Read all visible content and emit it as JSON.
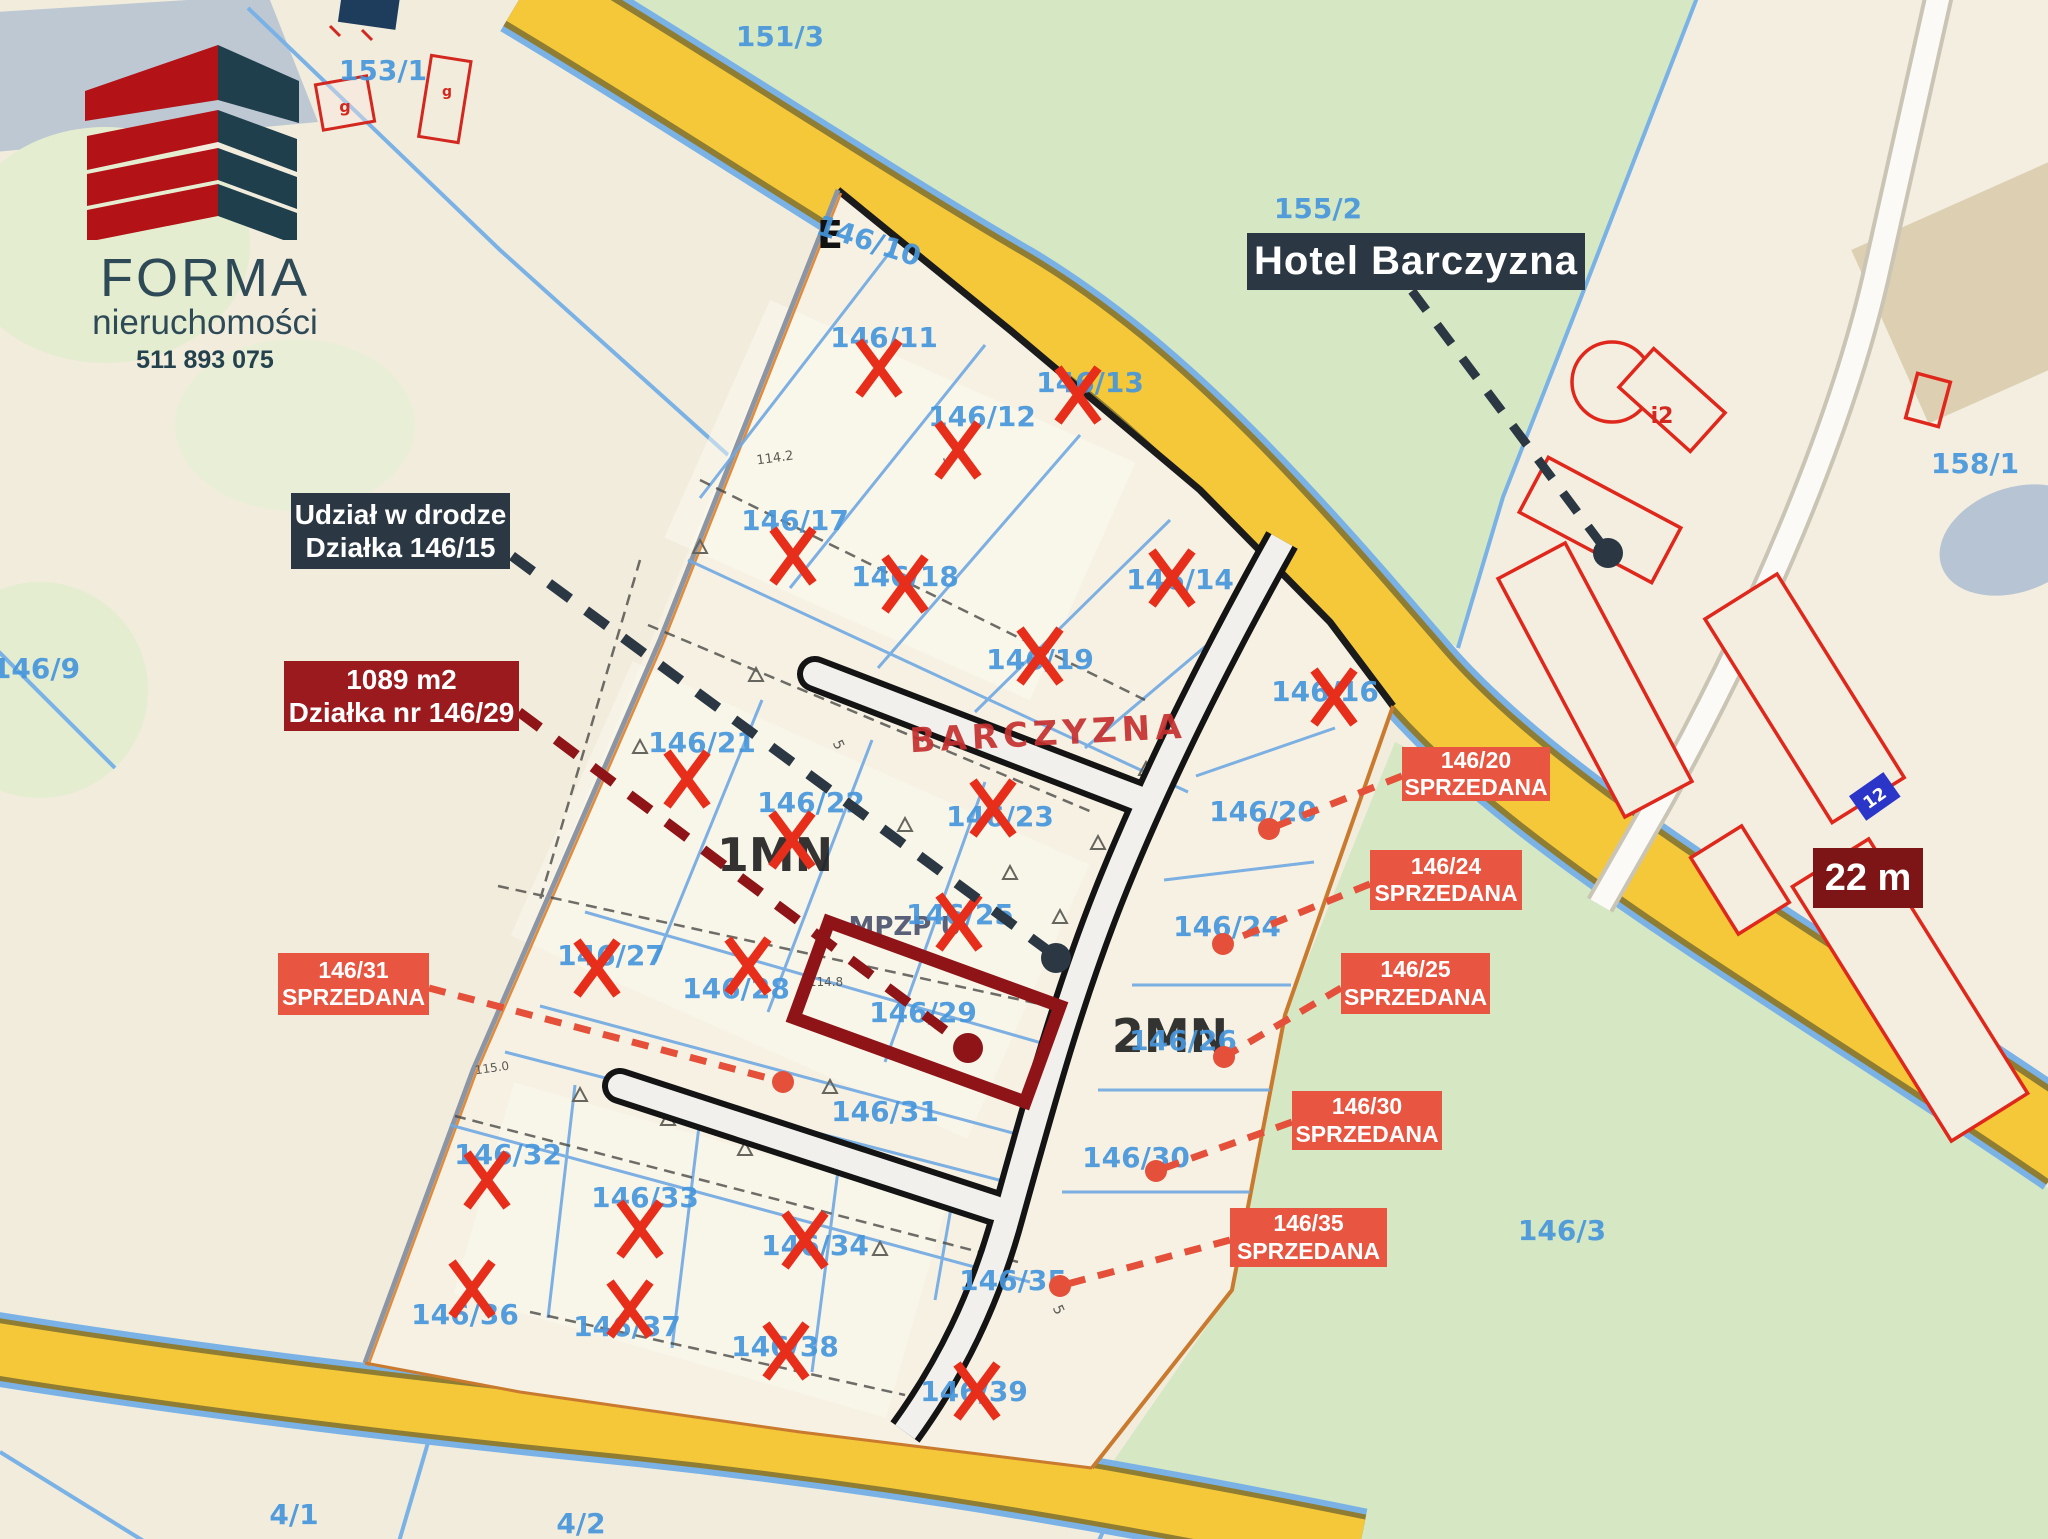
{
  "branding": {
    "company": "FORMA",
    "subtitle": "nieruchomości",
    "phone": "511 893 075"
  },
  "callouts": {
    "hotel": {
      "text": "Hotel Barczyzna",
      "bg": "#2b3844"
    },
    "road_share": {
      "line1": "Udział w drodze",
      "line2": "Działka 146/15",
      "bg": "#2b3844"
    },
    "offer": {
      "line1": "1089 m2",
      "line2": "Działka nr 146/29",
      "bg": "#9a1a1d"
    },
    "frontage": {
      "text": "22 m",
      "bg": "#7d1517"
    },
    "sold_status": "SPRZEDANA",
    "sold_color": "#e85540",
    "sold": [
      {
        "plot": "146/20",
        "status": "SPRZEDANA",
        "box": [
          1402,
          747,
          148,
          54
        ],
        "anchor": [
          1402,
          776
        ],
        "dot": [
          1269,
          829
        ]
      },
      {
        "plot": "146/24",
        "status": "SPRZEDANA",
        "box": [
          1370,
          850,
          152,
          60
        ],
        "anchor": [
          1370,
          884
        ],
        "dot": [
          1223,
          944
        ]
      },
      {
        "plot": "146/25",
        "status": "SPRZEDANA",
        "box": [
          1341,
          953,
          149,
          61
        ],
        "anchor": [
          1341,
          988
        ],
        "dot": [
          1224,
          1057
        ]
      },
      {
        "plot": "146/30",
        "status": "SPRZEDANA",
        "box": [
          1292,
          1091,
          150,
          59
        ],
        "anchor": [
          1292,
          1122
        ],
        "dot": [
          1156,
          1171
        ]
      },
      {
        "plot": "146/35",
        "status": "SPRZEDANA",
        "box": [
          1230,
          1208,
          157,
          59
        ],
        "anchor": [
          1230,
          1240
        ],
        "dot": [
          1060,
          1286
        ]
      },
      {
        "plot": "146/31",
        "status": "SPRZEDANA",
        "box": [
          278,
          953,
          151,
          62
        ],
        "anchor": [
          429,
          988
        ],
        "dot": [
          783,
          1082
        ]
      }
    ]
  },
  "map": {
    "zone1": "1MN",
    "zone2": "2MN",
    "street_name": "BARCZYZNA",
    "plan_code": "MPZP U",
    "letter_e": "E",
    "building_i2": "i2",
    "building_g": "g",
    "building_12": "12",
    "micro": {
      "a": "114.2",
      "b": "114.8",
      "c": "115.0",
      "five": "5"
    },
    "parcels": [
      {
        "id": "151/3",
        "x": 780,
        "y": 46
      },
      {
        "id": "153/1",
        "x": 383,
        "y": 80
      },
      {
        "id": "155/2",
        "x": 1318,
        "y": 218
      },
      {
        "id": "158/1",
        "x": 1975,
        "y": 473
      },
      {
        "id": "146/9",
        "x": 36,
        "y": 678
      },
      {
        "id": "146/3",
        "x": 1562,
        "y": 1240
      },
      {
        "id": "4/1",
        "x": 294,
        "y": 1524
      },
      {
        "id": "4/2",
        "x": 581,
        "y": 1533
      },
      {
        "id": "146/10",
        "x": 866,
        "y": 250,
        "rot": 18
      },
      {
        "id": "146/11",
        "x": 884,
        "y": 347,
        "cross": [
          879,
          368
        ]
      },
      {
        "id": "146/12",
        "x": 982,
        "y": 426,
        "cross": [
          958,
          450
        ]
      },
      {
        "id": "146/13",
        "x": 1090,
        "y": 392,
        "cross": [
          1078,
          395
        ]
      },
      {
        "id": "146/14",
        "x": 1180,
        "y": 589,
        "cross": [
          1172,
          578
        ]
      },
      {
        "id": "146/16",
        "x": 1325,
        "y": 701,
        "cross": [
          1334,
          697
        ]
      },
      {
        "id": "146/17",
        "x": 795,
        "y": 530,
        "cross": [
          793,
          556
        ]
      },
      {
        "id": "146/18",
        "x": 905,
        "y": 586,
        "cross": [
          905,
          584
        ]
      },
      {
        "id": "146/19",
        "x": 1040,
        "y": 669,
        "cross": [
          1040,
          656
        ]
      },
      {
        "id": "146/21",
        "x": 702,
        "y": 752,
        "cross": [
          687,
          779
        ]
      },
      {
        "id": "146/22",
        "x": 811,
        "y": 812,
        "cross": [
          792,
          840
        ]
      },
      {
        "id": "146/23",
        "x": 1000,
        "y": 826,
        "cross": [
          993,
          808
        ]
      },
      {
        "id": "146/25",
        "x": 960,
        "y": 924,
        "cross": [
          959,
          922
        ]
      },
      {
        "id": "146/26",
        "x": 1183,
        "y": 1050
      },
      {
        "id": "146/20",
        "x": 1263,
        "y": 821
      },
      {
        "id": "146/24",
        "x": 1227,
        "y": 936
      },
      {
        "id": "146/27",
        "x": 611,
        "y": 965,
        "cross": [
          597,
          968
        ]
      },
      {
        "id": "146/28",
        "x": 736,
        "y": 998,
        "cross": [
          748,
          966
        ]
      },
      {
        "id": "146/29",
        "x": 923,
        "y": 1022
      },
      {
        "id": "146/30",
        "x": 1136,
        "y": 1167
      },
      {
        "id": "146/31",
        "x": 885,
        "y": 1121
      },
      {
        "id": "146/32",
        "x": 508,
        "y": 1164,
        "cross": [
          487,
          1180
        ]
      },
      {
        "id": "146/33",
        "x": 645,
        "y": 1207,
        "cross": [
          640,
          1229
        ]
      },
      {
        "id": "146/34",
        "x": 815,
        "y": 1255,
        "cross": [
          805,
          1240
        ]
      },
      {
        "id": "146/35",
        "x": 1013,
        "y": 1290
      },
      {
        "id": "146/36",
        "x": 465,
        "y": 1324,
        "cross": [
          472,
          1289
        ]
      },
      {
        "id": "146/37",
        "x": 627,
        "y": 1336,
        "cross": [
          630,
          1309
        ]
      },
      {
        "id": "146/38",
        "x": 785,
        "y": 1356,
        "cross": [
          786,
          1351
        ]
      },
      {
        "id": "146/39",
        "x": 974,
        "y": 1401,
        "cross": [
          977,
          1391
        ]
      }
    ]
  },
  "colors": {
    "background": "#f2ecdd",
    "plat_fill": "#f6f1e3",
    "green": "#d5e7c3",
    "pale_green": "#e5edd0",
    "road_yellow": "#f4c838",
    "map_blue": "#4696dc",
    "x_red": "#e62e1b",
    "navy": "#2b3844",
    "dark_red": "#9a1a1d",
    "deep_red": "#7d1517",
    "sold_orange": "#e85540",
    "brand_red": "#b31217",
    "brand_dark": "#1f3f4d"
  }
}
